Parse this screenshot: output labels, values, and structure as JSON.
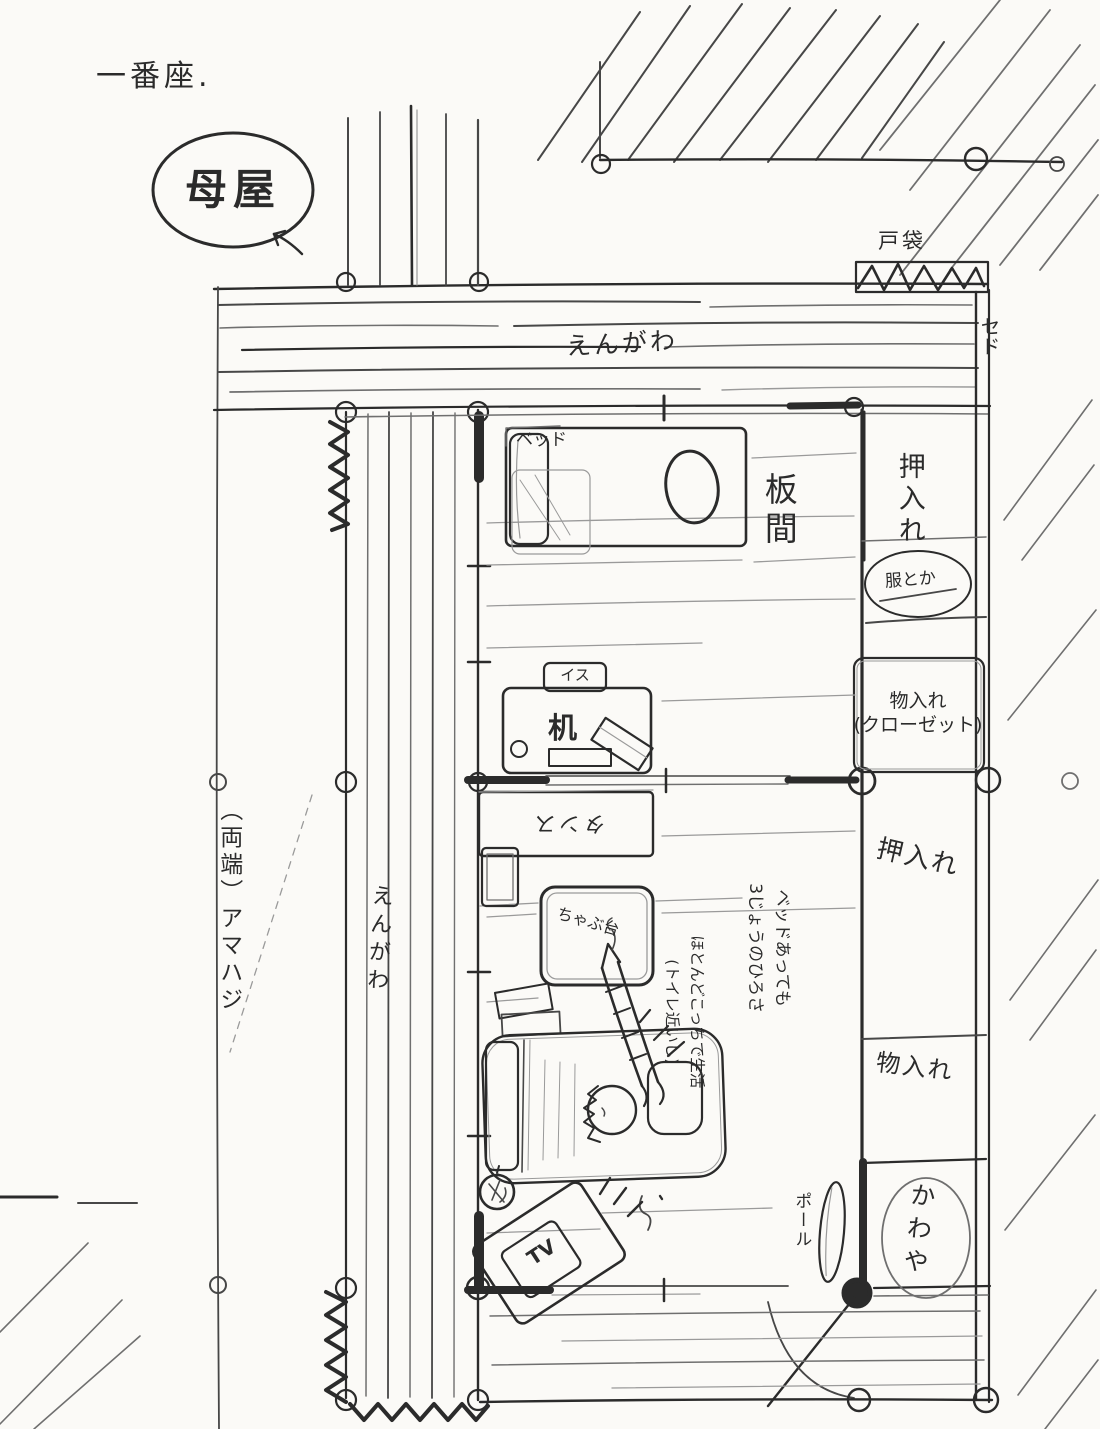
{
  "colors": {
    "paper": "#fbfaf7",
    "ink": "#2b2b2b",
    "pencil": "#6f6f6f"
  },
  "labels": {
    "title": "一番座.",
    "main_house": "母屋",
    "tobukuro": "戸袋",
    "sedo": "セド",
    "engawa_top": "えんがわ",
    "engawa_side": "えんがわ",
    "itanoma": "板間",
    "bed": "ベッド",
    "oshiire_top": "押入れ",
    "fuku_toka": "服とか",
    "monoire_closet": "物入れ\n(クローゼット)",
    "isu": "イス",
    "tsukue": "机",
    "tansu": "タンス",
    "chabudai": "ちゃぶ台",
    "note_bed": "ベッドあっても\n3じょうのひろさ",
    "note_life": "ほとんどこっちで生活\n(トイレ近いし)",
    "ryotan_amahaji": "（両端）アマハジ",
    "oshiire_mid": "押入れ",
    "monoire2": "物入れ",
    "kawaya": "かわや",
    "pole": "ポール",
    "tv": "TV"
  }
}
